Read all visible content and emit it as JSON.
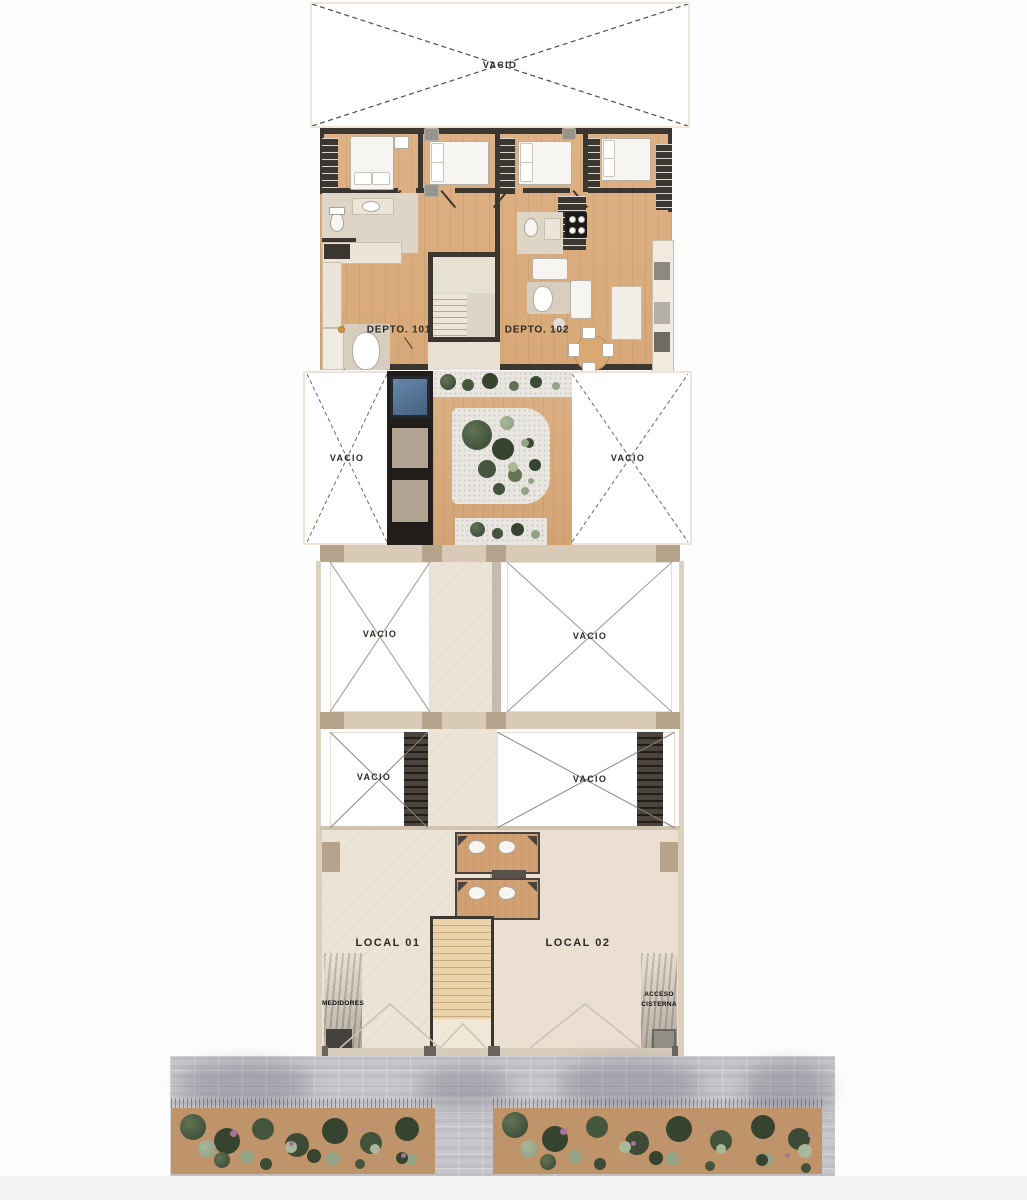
{
  "meta": {
    "title": "Plano arquitectónico — planta de niveles del edificio"
  },
  "labels": {
    "vacio": "VACIO",
    "depto_101": "DEPTO. 101",
    "depto_102": "DEPTO. 102",
    "local_01": "LOCAL 01",
    "local_02": "LOCAL 02",
    "medidores": "MEDIDORES",
    "acceso_line1": "ACCESO",
    "acceso_line2": "CISTERNA"
  },
  "palette": {
    "wall_dark": "#3b3630",
    "wood_floor": "#ddb083",
    "tile_light": "#ddd5c6",
    "cream_floor": "#ece4d6",
    "beam_tan": "#d8cab6",
    "pillar_tan": "#b5a38b",
    "skylight_blue": "#5c7a9e",
    "gravel": "#e9e6e1",
    "plant_dark": "#41503c",
    "plant_mid": "#617453",
    "plant_sage": "#93a385",
    "soil": "#c0946a",
    "pavement": "#c7c6cb",
    "white_fixture": "#f7f5f1"
  }
}
